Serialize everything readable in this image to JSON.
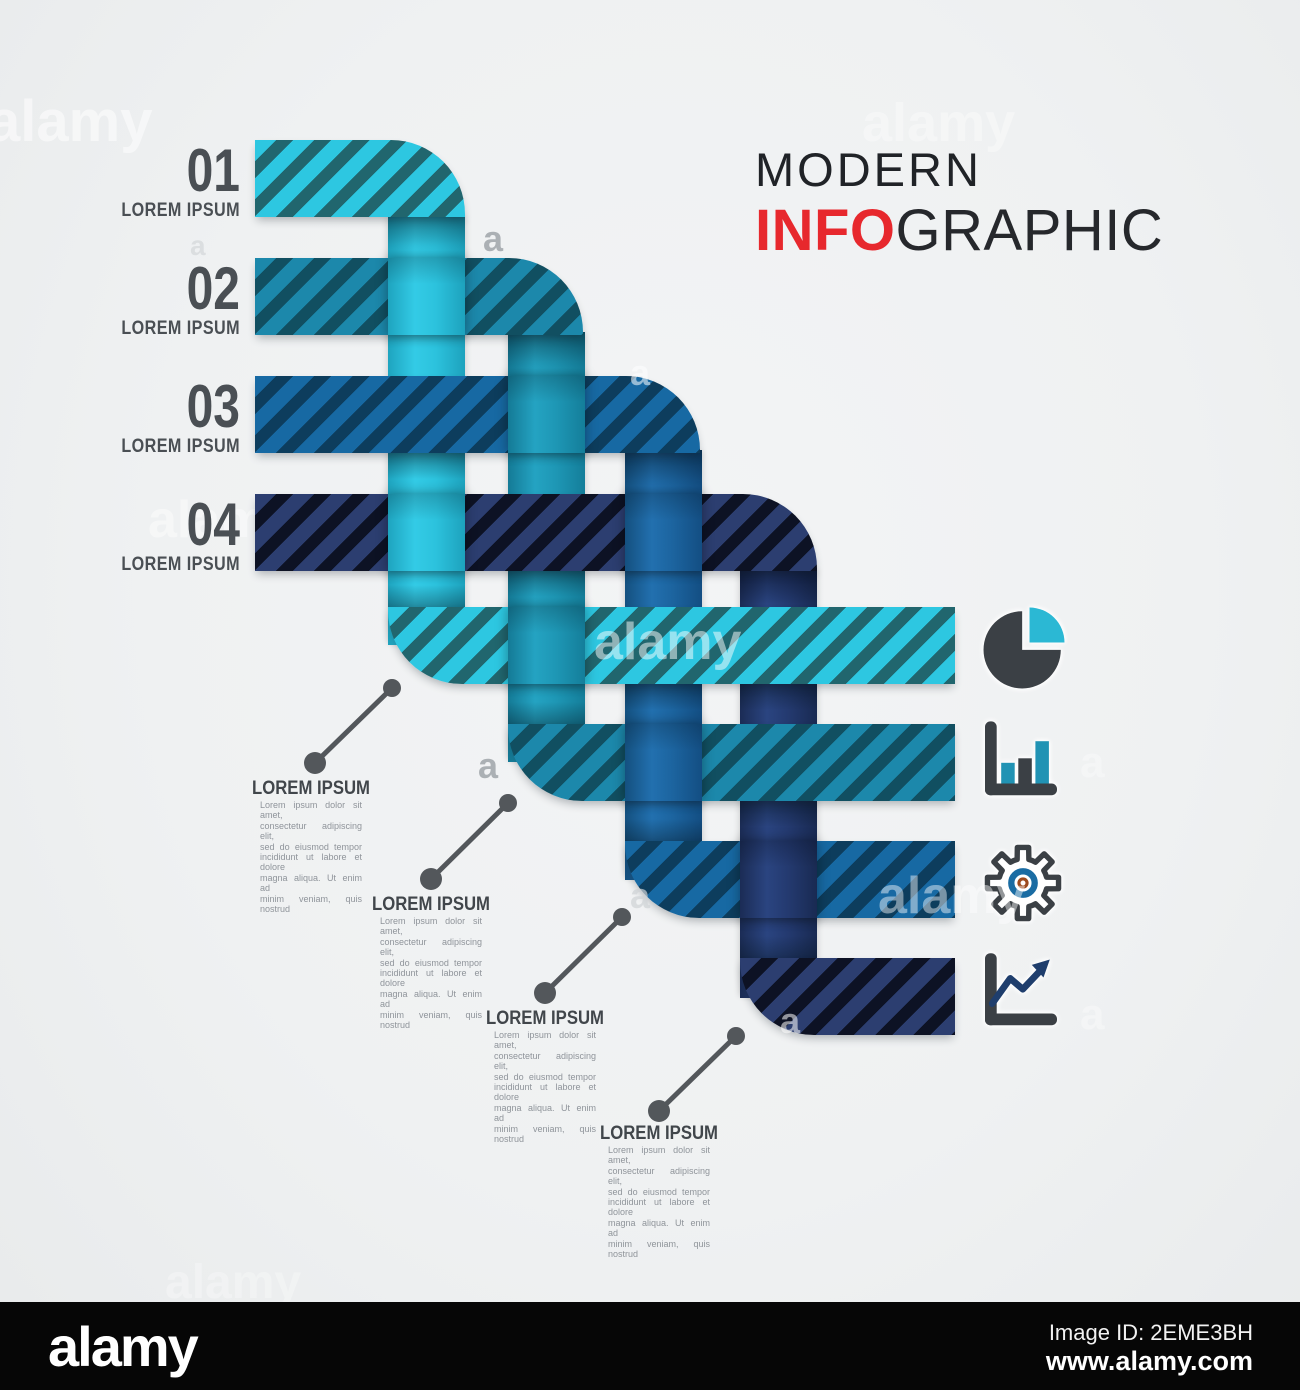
{
  "title": {
    "line1": "MODERN",
    "line2_accent": "INFO",
    "line2_rest": "GRAPHIC",
    "accent_color": "#e7282d"
  },
  "steps": [
    {
      "number": "01",
      "label": "LOREM IPSUM"
    },
    {
      "number": "02",
      "label": "LOREM IPSUM"
    },
    {
      "number": "03",
      "label": "LOREM IPSUM"
    },
    {
      "number": "04",
      "label": "LOREM IPSUM"
    }
  ],
  "callouts": [
    {
      "heading": "LOREM IPSUM",
      "body_lines": [
        "Lorem ipsum dolor sit amet,",
        "consectetur adipiscing elit,",
        "sed do eiusmod tempor",
        "incididunt ut labore et dolore",
        "magna aliqua. Ut enim ad",
        "minim veniam, quis nostrud"
      ]
    },
    {
      "heading": "LOREM IPSUM",
      "body_lines": [
        "Lorem ipsum dolor sit amet,",
        "consectetur adipiscing elit,",
        "sed do eiusmod tempor",
        "incididunt ut labore et dolore",
        "magna aliqua. Ut enim ad",
        "minim veniam, quis nostrud"
      ]
    },
    {
      "heading": "LOREM IPSUM",
      "body_lines": [
        "Lorem ipsum dolor sit amet,",
        "consectetur adipiscing elit,",
        "sed do eiusmod tempor",
        "incididunt ut labore et dolore",
        "magna aliqua. Ut enim ad",
        "minim veniam, quis nostrud"
      ]
    },
    {
      "heading": "LOREM IPSUM",
      "body_lines": [
        "Lorem ipsum dolor sit amet,",
        "consectetur adipiscing elit,",
        "sed do eiusmod tempor",
        "incididunt ut labore et dolore",
        "magna aliqua. Ut enim ad",
        "minim veniam, quis nostrud"
      ]
    }
  ],
  "icons": [
    {
      "name": "pie-chart-icon"
    },
    {
      "name": "bar-chart-icon"
    },
    {
      "name": "gear-icon"
    },
    {
      "name": "line-chart-icon"
    }
  ],
  "palette": {
    "ribbon1_light": "#2dc7e1",
    "ribbon1_dark": "#21666e",
    "ribbon2_light": "#1c88ab",
    "ribbon2_dark": "#114f61",
    "ribbon3_light": "#1769a3",
    "ribbon3_dark": "#0d3d5d",
    "ribbon4_light": "#2c3e70",
    "ribbon4_dark": "#0d1224",
    "icon_dark": "#3b4045",
    "icon_cyan": "#2bb8d4",
    "icon_blue": "#1f3e6d",
    "title_accent": "#e7282d",
    "text_gray": "#8f949a"
  },
  "watermark": {
    "logo": "alamy",
    "letter": "a"
  },
  "footer": {
    "logo": "alamy",
    "image_id": "Image ID: 2EME3BH",
    "url": "www.alamy.com"
  }
}
